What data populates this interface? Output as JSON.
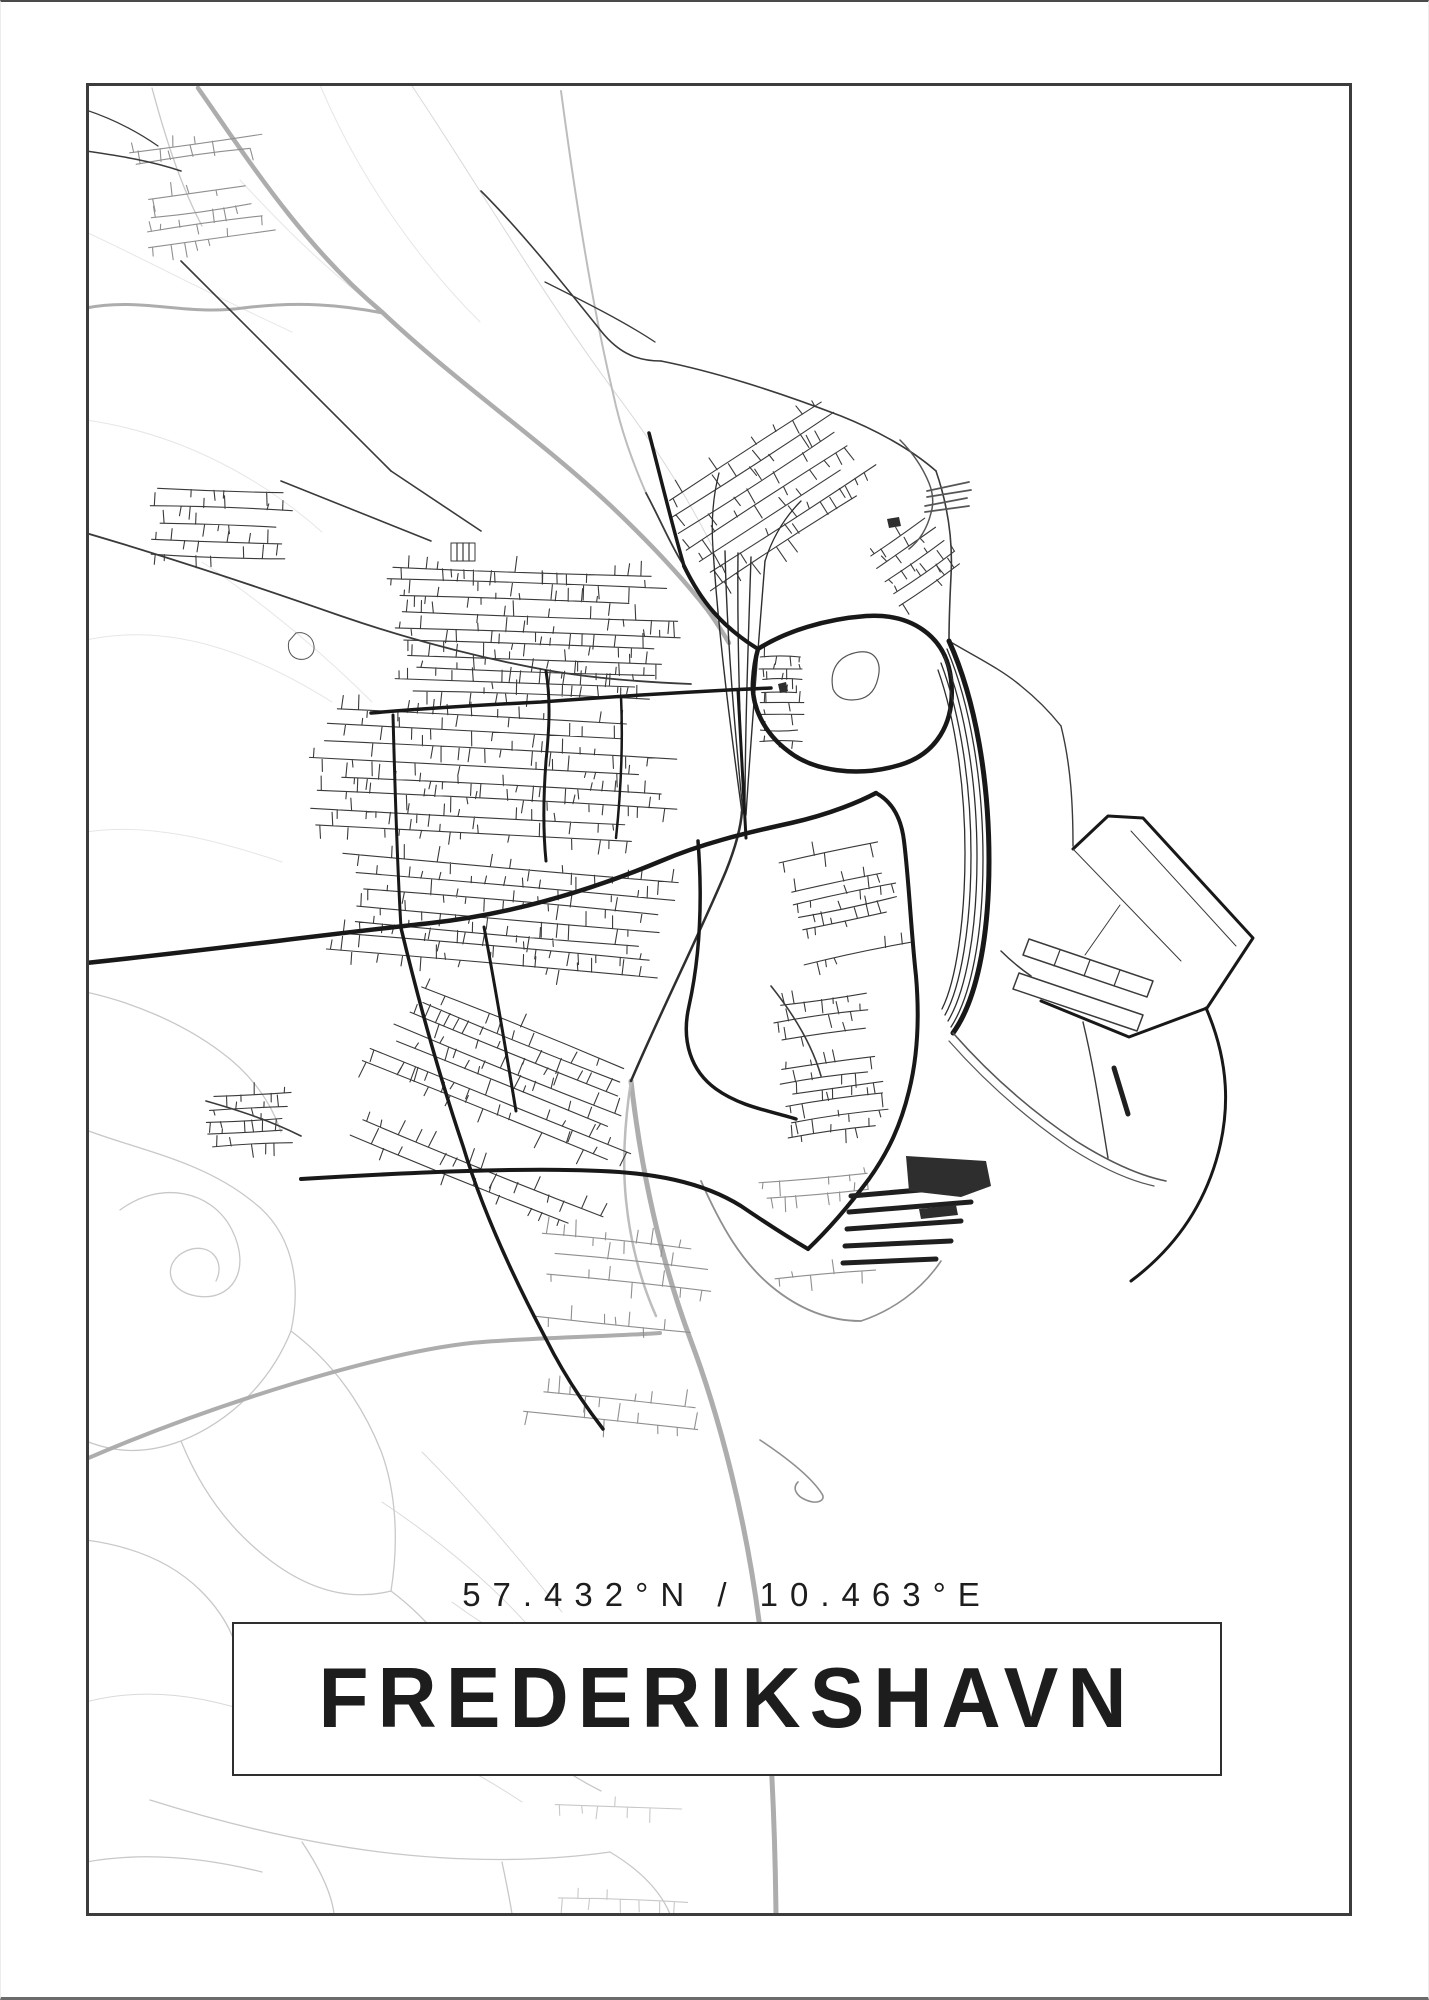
{
  "poster": {
    "coordinates": "57.432°N / 10.463°E",
    "title_box": {
      "city": "FREDERIKSHAVN"
    },
    "colors": {
      "background": "#ffffff",
      "frame_border": "#3c3c3c",
      "ink": "#1d1d1d",
      "map": {
        "faint": "#e6e6e6",
        "xlight": "#d9d9d9",
        "light": "#c8c8c8",
        "midgray": "#8f8f8f",
        "gray": "#adadad",
        "grayline": "#bdbdbd",
        "street": "#3a3a3a",
        "dark": "#181818",
        "rail": "#2e2e2e",
        "steel": "#565656",
        "pier": "#1f1f1f",
        "blob": "#2e2e2e"
      }
    }
  }
}
